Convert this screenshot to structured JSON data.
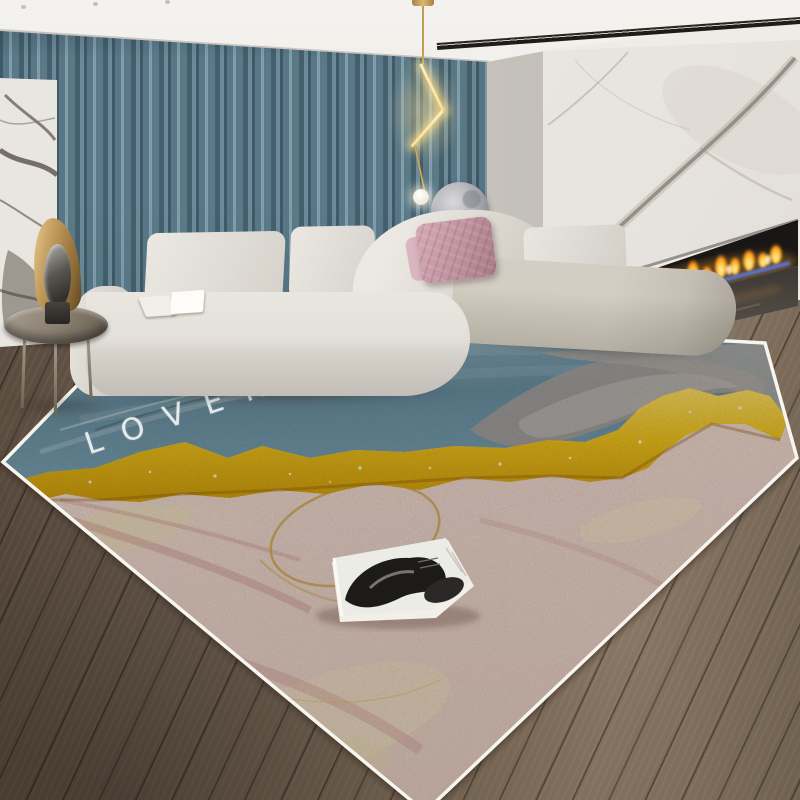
{
  "scene": {
    "description": "Modern living room product photo: beige corner sofa, blue pleated curtains, marble feature wall, linear fireplace, gold pendant light and an abstract blue-gold-pink area rug",
    "rug": {
      "word_lover": "LOVER",
      "word_of": "of",
      "word_city": "CITY",
      "colors": {
        "blue_field": "#7ba3b3",
        "gold_band": "#f0c41d",
        "pink_field": "#f1dcd2",
        "grey_patch": "#a8a39e",
        "lettering": "#f4f7f7",
        "binding": "#f8f5ef"
      }
    },
    "palette": {
      "ceiling": "#eeece7",
      "curtains": "#5a7a8a",
      "corner_wall": "#d3cfc9",
      "marble_wall": "#ece9e5",
      "sofa": "#e0ddd7",
      "pillow_pink": "#c49aa8",
      "moon_lamp": "#9fa0a8",
      "pendant_gold": "#c9a25c",
      "flame_orange": "#ffae2e",
      "flame_blue": "#6079e2",
      "floor_wood": "#6b5c4e",
      "table_bronze": "#877d6e"
    }
  }
}
